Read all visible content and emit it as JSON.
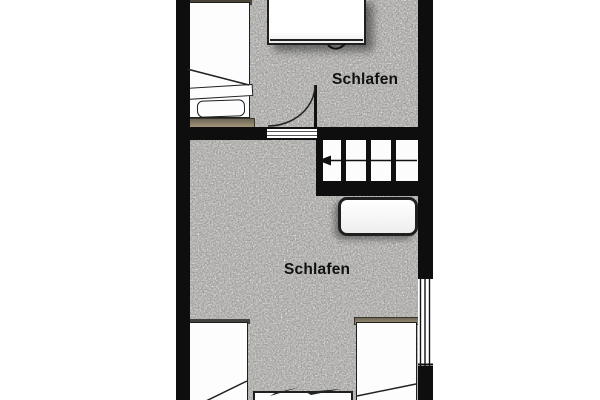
{
  "rooms": [
    {
      "name": "bedroom-upper",
      "label": "Schlafen"
    },
    {
      "name": "bedroom-lower",
      "label": "Schlafen"
    }
  ],
  "colors": {
    "wall": "#0e0e0e",
    "floor": "#e9e8e5",
    "furniture": "#fdfdfd",
    "outline": "#1f1f1f",
    "wood_trim": "#a2957a",
    "wood_trim_dark": "#6e6654",
    "label_text": "#111111"
  },
  "furniture": [
    {
      "name": "single-bed",
      "room": "bedroom-upper"
    },
    {
      "name": "wardrobe",
      "room": "bedroom-upper"
    },
    {
      "name": "chest",
      "room": "bedroom-lower"
    },
    {
      "name": "single-bed-left",
      "room": "bedroom-lower"
    },
    {
      "name": "single-bed-right",
      "room": "bedroom-lower"
    },
    {
      "name": "bedside-table",
      "room": "bedroom-lower"
    }
  ],
  "circulation": {
    "door": {
      "type": "swing-door",
      "swing": "quarter-arc"
    },
    "stairs": {
      "treads": 4,
      "direction_arrow": "left"
    },
    "window": {
      "wall": "right"
    }
  }
}
